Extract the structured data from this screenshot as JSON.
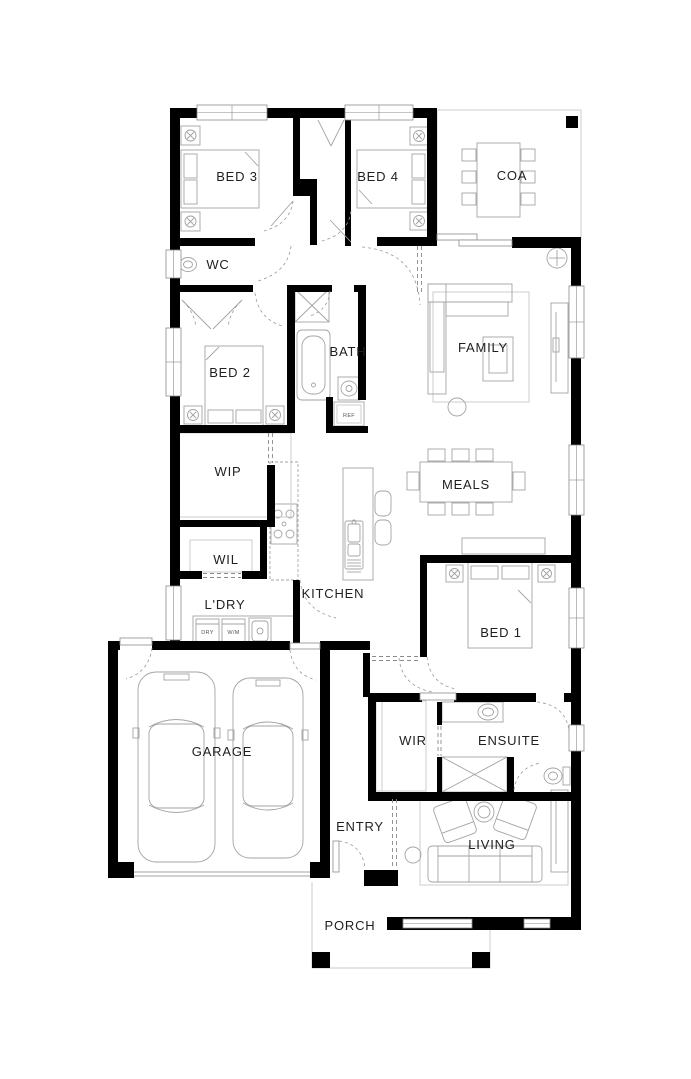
{
  "plan": {
    "rooms": {
      "bed3": "BED 3",
      "bed4": "BED 4",
      "coa": "COA",
      "wc": "WC",
      "bath": "BATH",
      "family": "FAMILY",
      "bed2": "BED 2",
      "wip": "WIP",
      "meals": "MEALS",
      "wil": "WIL",
      "kitchen": "KITCHEN",
      "ldry": "L'DRY",
      "bed1": "BED 1",
      "garage": "GARAGE",
      "wir": "WIR",
      "ensuite": "ENSUITE",
      "entry": "ENTRY",
      "living": "LIVING",
      "porch": "PORCH"
    },
    "appliances": {
      "fridge": "REF",
      "dryer": "DRY",
      "washer": "W/M"
    },
    "colors": {
      "wall": "#000000",
      "furniture_line": "#a3a3a3",
      "label": "#1f1f1f",
      "background": "#ffffff"
    }
  }
}
